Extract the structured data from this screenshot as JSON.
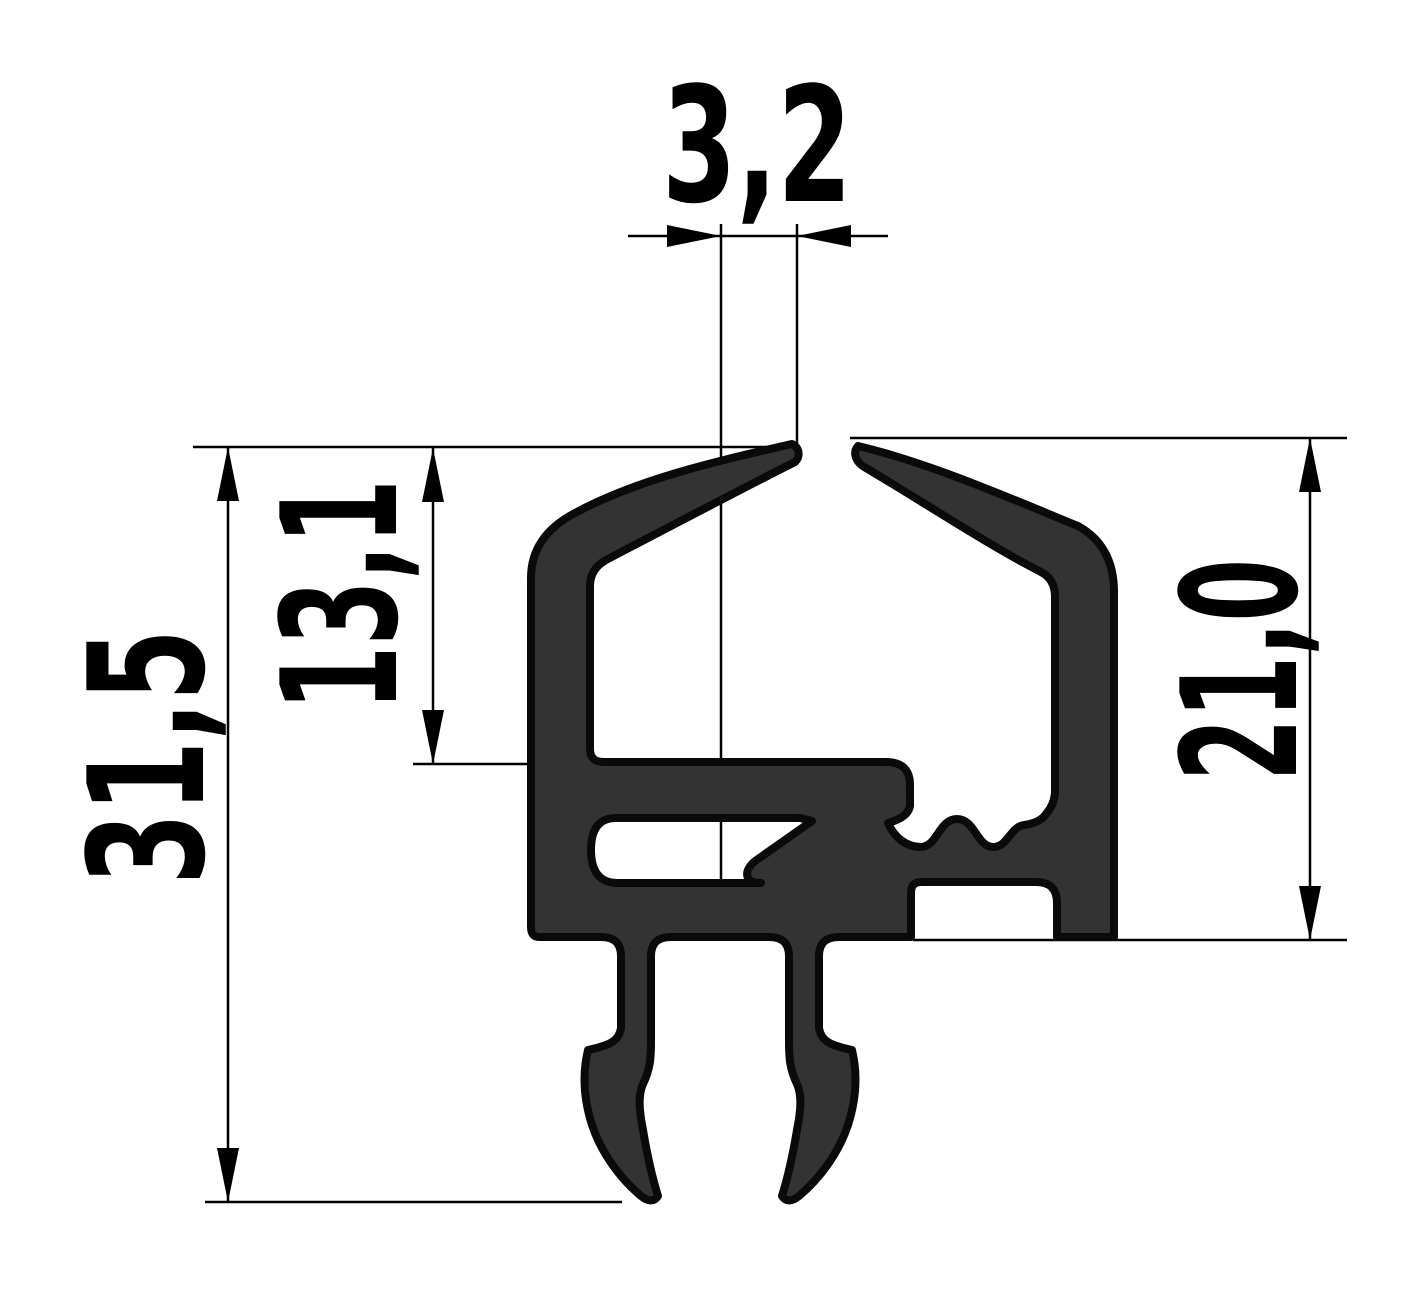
{
  "drawing": {
    "kind": "technical cross-section of extruded seal profile",
    "dimensions": {
      "gap_top": {
        "label": "3,2",
        "value": 3.2,
        "orientation": "horizontal"
      },
      "overall_height": {
        "label": "31,5",
        "value": 31.5,
        "orientation": "vertical"
      },
      "upper_height": {
        "label": "13,1",
        "value": 13.1,
        "orientation": "vertical"
      },
      "right_height": {
        "label": "21,0",
        "value": 21.0,
        "orientation": "vertical"
      }
    },
    "colors": {
      "background": "#ffffff",
      "profile_fill": "#333333",
      "outline": "#0a0a0a",
      "dimension_line": "#000000"
    }
  }
}
